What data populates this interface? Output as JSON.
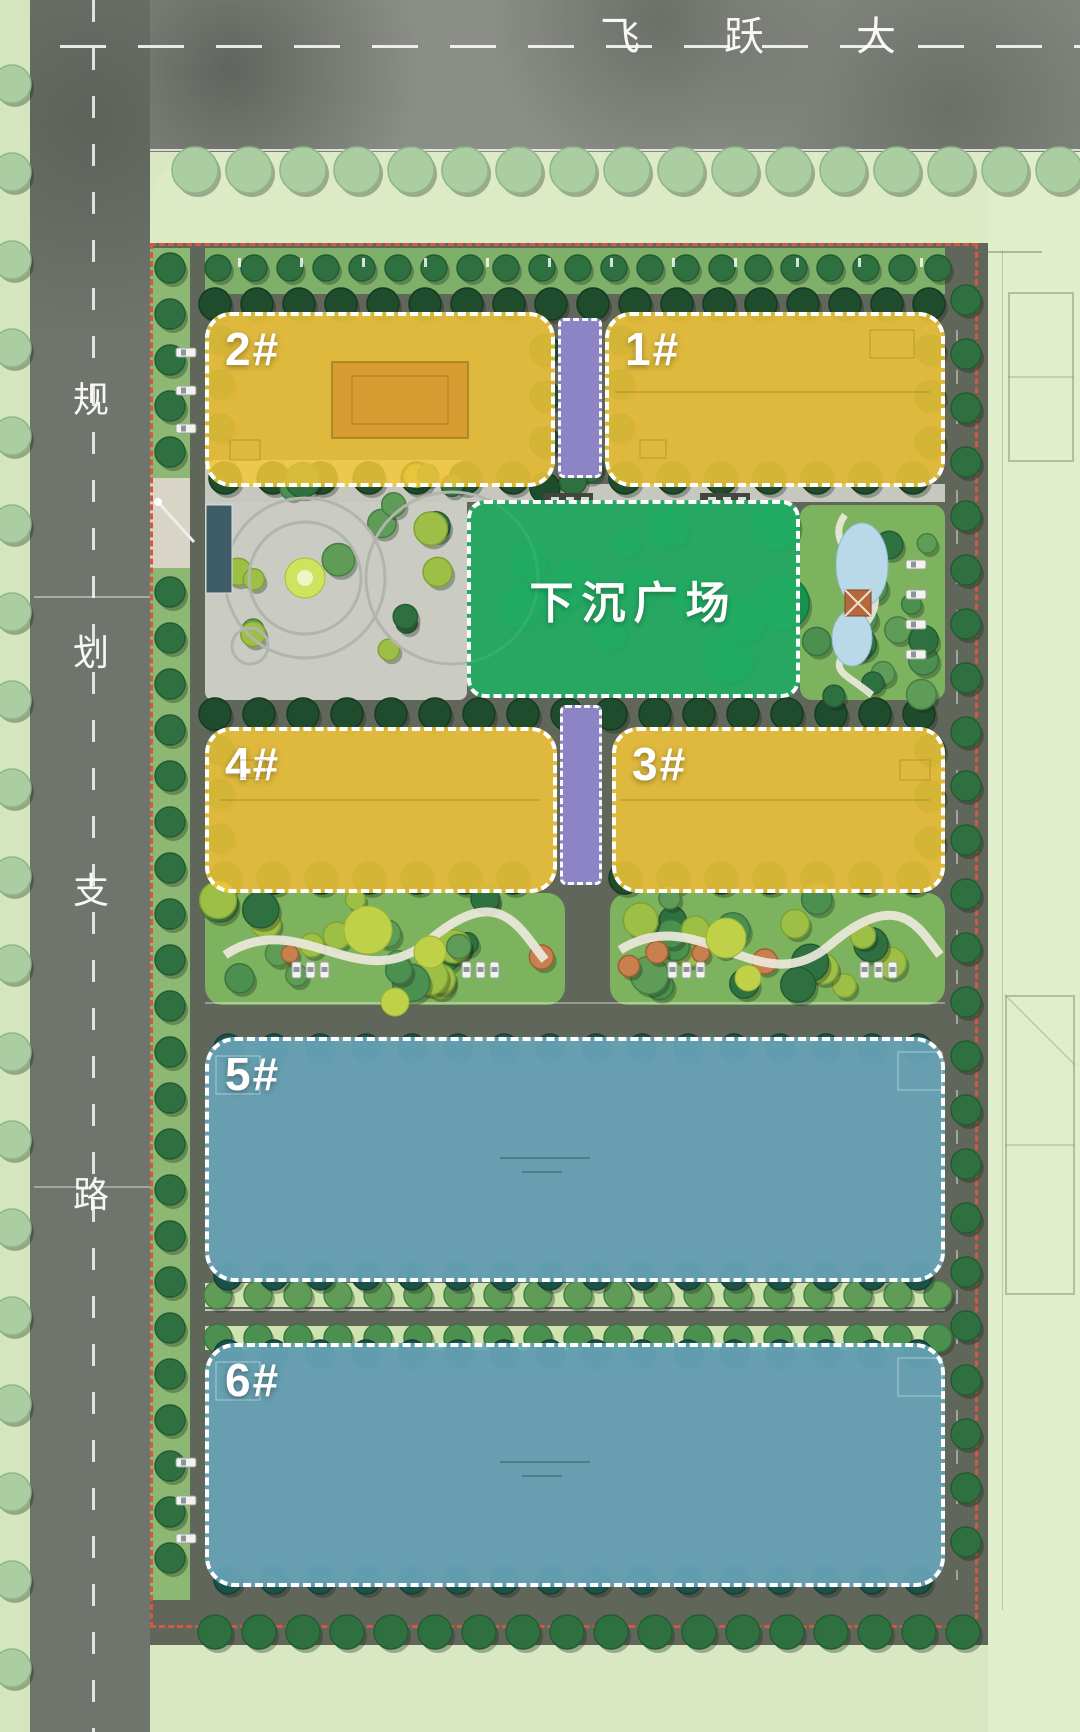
{
  "plan": {
    "top_road": {
      "label": "飞跃大",
      "chars": [
        "飞",
        "跃",
        "大"
      ]
    },
    "left_road": {
      "label": "规划支路",
      "chars": [
        "规",
        "划",
        "支",
        "路"
      ]
    },
    "plaza": {
      "label": "下沉广场",
      "color": "#2BB169"
    },
    "buildings": [
      {
        "id": "b1",
        "label": "1#",
        "color": "#F2C63F"
      },
      {
        "id": "b2",
        "label": "2#",
        "color": "#F2C63F"
      },
      {
        "id": "b3",
        "label": "3#",
        "color": "#F2C63F"
      },
      {
        "id": "b4",
        "label": "4#",
        "color": "#F2C63F"
      },
      {
        "id": "b5",
        "label": "5#",
        "color": "#6CA7BA"
      },
      {
        "id": "b6",
        "label": "6#",
        "color": "#6CA7BA"
      }
    ],
    "colors": {
      "boundary_red": "#CF5A43",
      "corridor_purple": "#8D84C6",
      "building_yellow": "#F2C63F",
      "building_blue": "#6CA7BA",
      "plaza_green": "#2BB169"
    }
  }
}
